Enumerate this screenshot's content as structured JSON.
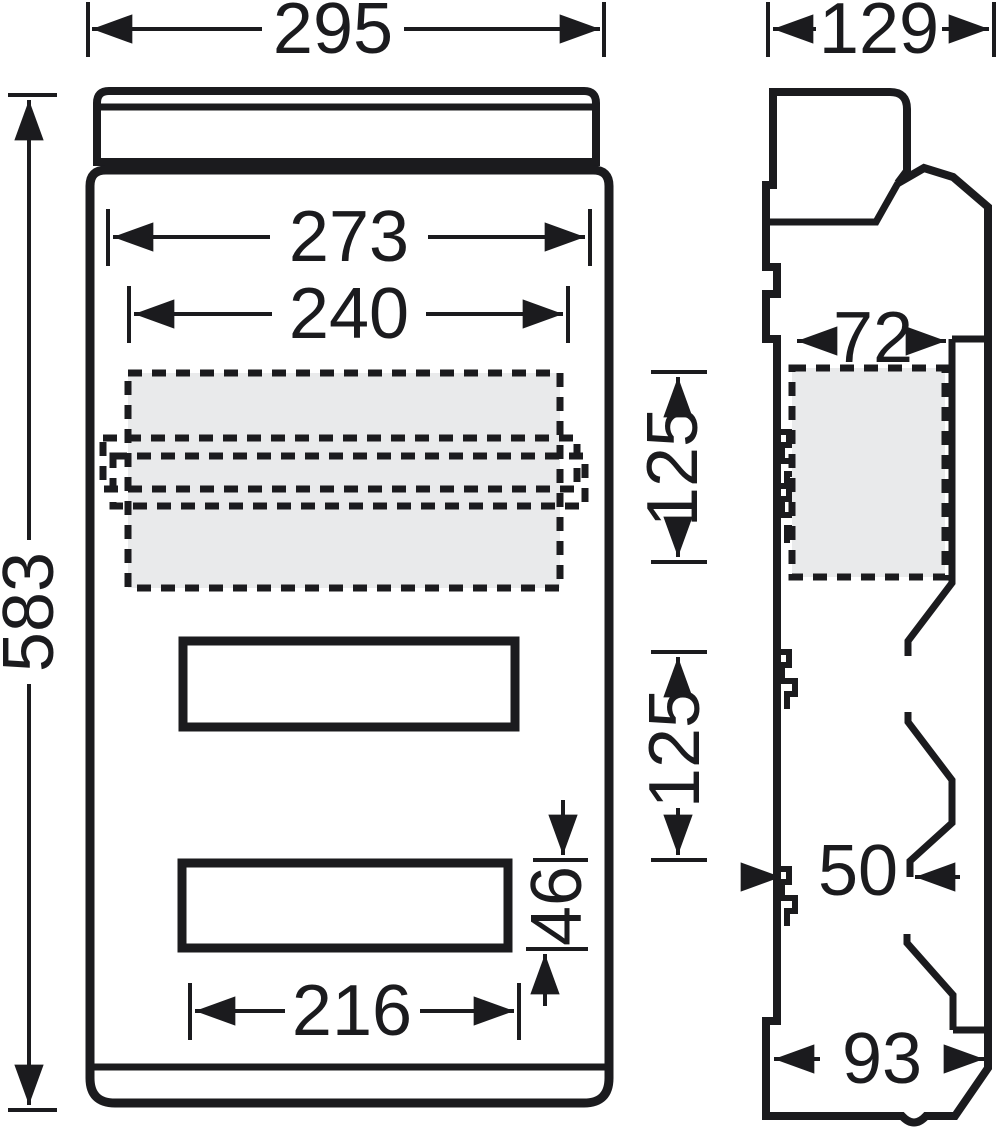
{
  "drawing": {
    "type": "technical-dimension-drawing",
    "subject": "enclosure front and side views",
    "colors": {
      "line": "#1b1b1e",
      "zone_fill": "#e9eaeb",
      "background": "#ffffff"
    },
    "front_view": {
      "overall_width": "295",
      "overall_height": "583",
      "opening_width": "273",
      "rail_width": "240",
      "slot_width": "216",
      "slot_height": "46",
      "row_pitch_top": "125",
      "row_pitch_bottom": "125"
    },
    "side_view": {
      "overall_depth": "129",
      "rail_zone_depth": "72",
      "duct_depth": "50",
      "base_depth": "93"
    }
  }
}
